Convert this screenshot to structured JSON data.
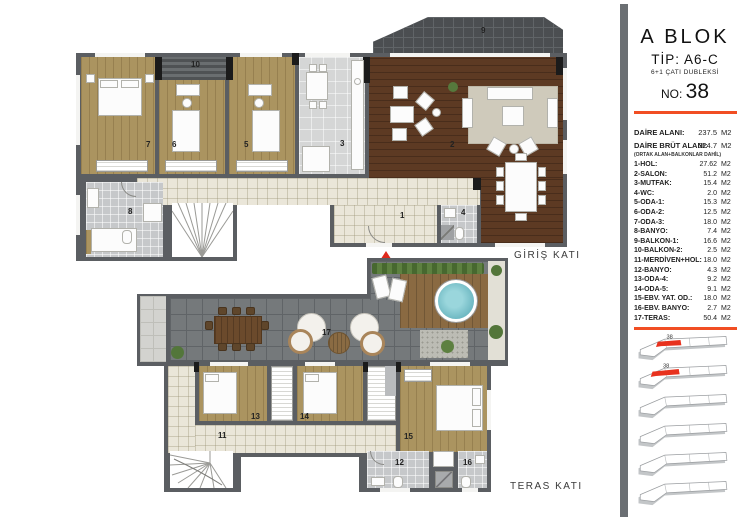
{
  "sidebar": {
    "block_title": "A BLOK",
    "type_label": "TİP: A6-C",
    "subtype_label": "6+1 ÇATI DUBLEKSİ",
    "no_label": "NO:",
    "no_value": "38",
    "floor_badge": "38",
    "area_rows": [
      {
        "label": "DAİRE ALANI:",
        "value": "237.5",
        "unit": "M2"
      },
      {
        "label": "DAİRE BRÜT ALANI:",
        "value": "324.7",
        "unit": "M2"
      }
    ],
    "area_note": "(ORTAK ALAN+BALKONLAR DAHİL)",
    "rooms": [
      {
        "label": "1-HOL:",
        "value": "27.62",
        "unit": "M2"
      },
      {
        "label": "2-SALON:",
        "value": "51.2",
        "unit": "M2"
      },
      {
        "label": "3-MUTFAK:",
        "value": "15.4",
        "unit": "M2"
      },
      {
        "label": "4-WC:",
        "value": "2.0",
        "unit": "M2"
      },
      {
        "label": "5-ODA-1:",
        "value": "15.3",
        "unit": "M2"
      },
      {
        "label": "6-ODA-2:",
        "value": "12.5",
        "unit": "M2"
      },
      {
        "label": "7-ODA-3:",
        "value": "18.0",
        "unit": "M2"
      },
      {
        "label": "8-BANYO:",
        "value": "7.4",
        "unit": "M2"
      },
      {
        "label": "9-BALKON-1:",
        "value": "16.6",
        "unit": "M2"
      },
      {
        "label": "10-BALKON-2:",
        "value": "2.5",
        "unit": "M2"
      },
      {
        "label": "11-MERDİVEN+HOL:",
        "value": "18.0",
        "unit": "M2"
      },
      {
        "label": "12-BANYO:",
        "value": "4.3",
        "unit": "M2"
      },
      {
        "label": "13-ODA-4:",
        "value": "9.2",
        "unit": "M2"
      },
      {
        "label": "14-ODA-5:",
        "value": "9.1",
        "unit": "M2"
      },
      {
        "label": "15-EBV. YAT. OD.:",
        "value": "18.0",
        "unit": "M2"
      },
      {
        "label": "16-EBV. BANYO:",
        "value": "2.7",
        "unit": "M2"
      },
      {
        "label": "17-TERAS:",
        "value": "50.4",
        "unit": "M2"
      }
    ]
  },
  "plans": {
    "upper_title": "GİRİŞ KATI",
    "lower_title": "TERAS KATI",
    "room_numbers": {
      "n1": "1",
      "n2": "2",
      "n3": "3",
      "n4": "4",
      "n5": "5",
      "n6": "6",
      "n7": "7",
      "n8": "8",
      "n9": "9",
      "n10": "10",
      "n11": "11",
      "n12": "12",
      "n13": "13",
      "n14": "14",
      "n15": "15",
      "n16": "16",
      "n17": "17"
    }
  },
  "colors": {
    "accent": "#f14e23",
    "highlight_red": "#e8321e",
    "wall_gray": "#5b5e62",
    "wood_light": "#ab9460",
    "wood_dark": "#5d3a23",
    "terrace_gray": "#75797b",
    "pool_blue": "#7cc4cd"
  }
}
